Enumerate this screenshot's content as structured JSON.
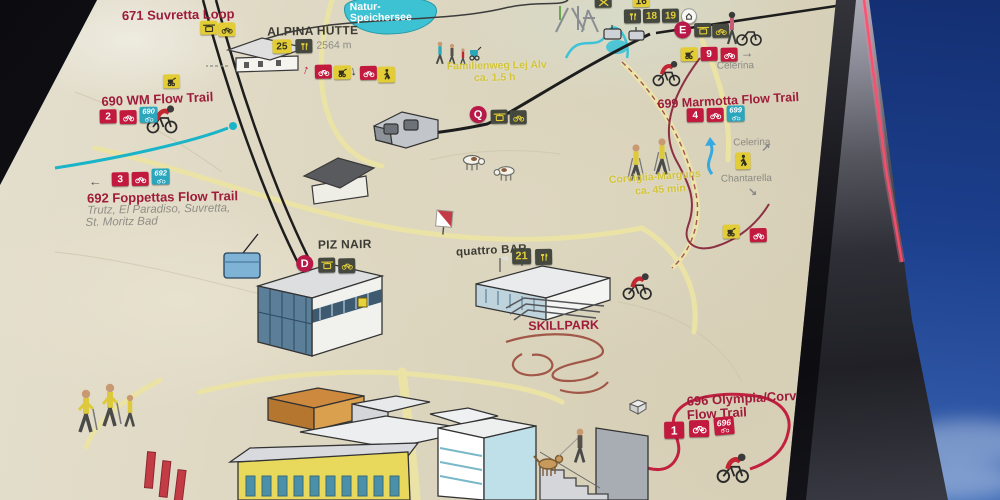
{
  "scene": {
    "description": "Photo of a mountain-bike trail map panel against a blue sky"
  },
  "glyphs": {
    "arrow_left": "←",
    "arrow_right": "→",
    "arrow_up": "↑",
    "arrow_down": "↓",
    "arrow_ne": "↗",
    "arrow_se": "↘"
  },
  "colors": {
    "map_background": "#dcd5bf",
    "trail_label_red": "#9e1b3a",
    "badge_red": "#c21a3f",
    "badge_yellow": "#e3cd36",
    "badge_dark": "#44483f",
    "route_badge_teal": "#2ba6bd",
    "lake_teal": "#3cc2d2",
    "path_yellow_text": "#d2c438",
    "sky_blue": "#1c3f8c",
    "frame_dark": "#2b2b31",
    "frame_edge_glow": "#ff4d6e"
  },
  "trails": {
    "t671": {
      "name": "671 Suvretta Loop"
    },
    "t690": {
      "name": "690 WM Flow Trail",
      "lift_number": "2",
      "route_number": "690"
    },
    "t692": {
      "name": "692 Foppettas Flow Trail",
      "destinations_line1": "Trutz, El Paradiso, Suvretta,",
      "destinations_line2": "St. Moritz Bad",
      "lift_number": "3",
      "route_number": "692"
    },
    "t699": {
      "name": "699 Marmotta Flow Trail",
      "lift_number": "4",
      "route_number": "699"
    },
    "t696": {
      "name_line1": "696 Olympia/Corviglia",
      "name_line2": "Flow Trail",
      "lift_number": "1",
      "route_number": "696"
    },
    "t9": {
      "lift_number": "9"
    }
  },
  "lifts": {
    "d": "D",
    "e": "E",
    "q": "Q"
  },
  "places": {
    "alpina_huette": {
      "name": "ALPINA HÜTTE",
      "elevation": "2564 m",
      "poi_number": "25"
    },
    "natur_speichersee": {
      "name_line1": "Natur-",
      "name_line2": "Speichersee"
    },
    "familienweg": {
      "name": "Familienweg Lej Alv",
      "duration": "ca. 1.5 h"
    },
    "corviglia_marguns": {
      "name": "Corviglia-Marguns",
      "duration": "ca. 45 min"
    },
    "piz_nair": {
      "name": "PIZ NAIR"
    },
    "quattro_bar": {
      "name": "quattro BAR",
      "poi_number": "21"
    },
    "skillpark": {
      "name": "SKILLPARK"
    },
    "celerina_upper": {
      "name": "Celerina"
    },
    "celerina_lower": {
      "name": "Celerina"
    },
    "chantarella": {
      "name": "Chantarella"
    }
  },
  "poi_numbers": {
    "b16": "16",
    "b18": "18",
    "b19": "19"
  }
}
